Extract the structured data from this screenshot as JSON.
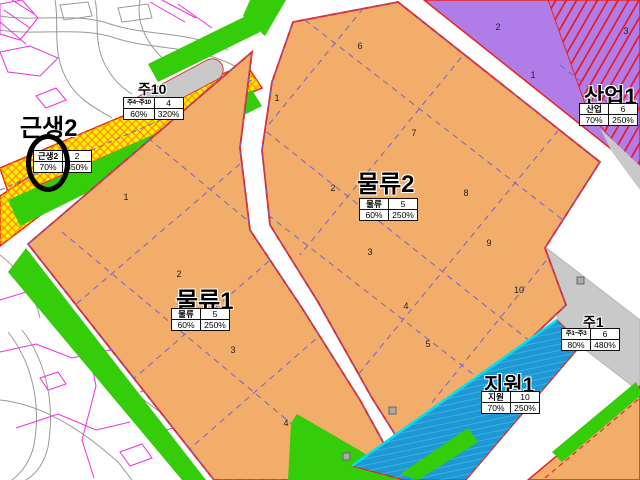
{
  "map_title": "토지이용계획도 (지구단위 물류단지 계획 평면도)",
  "zones": {
    "geunsaeng2": {
      "label": "근생2",
      "type": "근생2",
      "num": "2",
      "coverage": "70%",
      "far": "350%"
    },
    "ju10": {
      "label": "주10",
      "type": "주4~주10",
      "num": "4",
      "coverage": "60%",
      "far": "320%"
    },
    "mullyu1": {
      "label": "물류1",
      "type": "물류",
      "num": "5",
      "coverage": "60%",
      "far": "250%"
    },
    "mullyu2": {
      "label": "물류2",
      "type": "물류",
      "num": "5",
      "coverage": "60%",
      "far": "250%"
    },
    "saneop1": {
      "label": "산업1",
      "type": "산업",
      "num": "6",
      "coverage": "70%",
      "far": "250%"
    },
    "jiwon1": {
      "label": "지원1",
      "type": "지원",
      "num": "10",
      "coverage": "70%",
      "far": "250%"
    },
    "ju1": {
      "label": "주1",
      "type": "주1~주3",
      "num": "6",
      "coverage": "80%",
      "far": "480%"
    }
  },
  "parcels": {
    "m1": [
      "1",
      "2",
      "3",
      "4"
    ],
    "m2": [
      "1",
      "6",
      "7",
      "2",
      "3",
      "4",
      "5",
      "8",
      "9",
      "10"
    ],
    "ind": [
      "2",
      "1",
      "3"
    ]
  },
  "colors": {
    "logistics_orange": "#f1ad69",
    "buffer_green": "#35cc0a",
    "industry_purple": "#b07ce8",
    "support_blue": "#1e98d5",
    "neighborhood_yellow": "#ffef00",
    "residential_gray": "#c9c9c9",
    "boundary_red": "#e8241c",
    "district_dash": "#6f62d8",
    "support_edge_cyan": "#00e0f0",
    "cadastral_magenta": "#f22ce0"
  }
}
